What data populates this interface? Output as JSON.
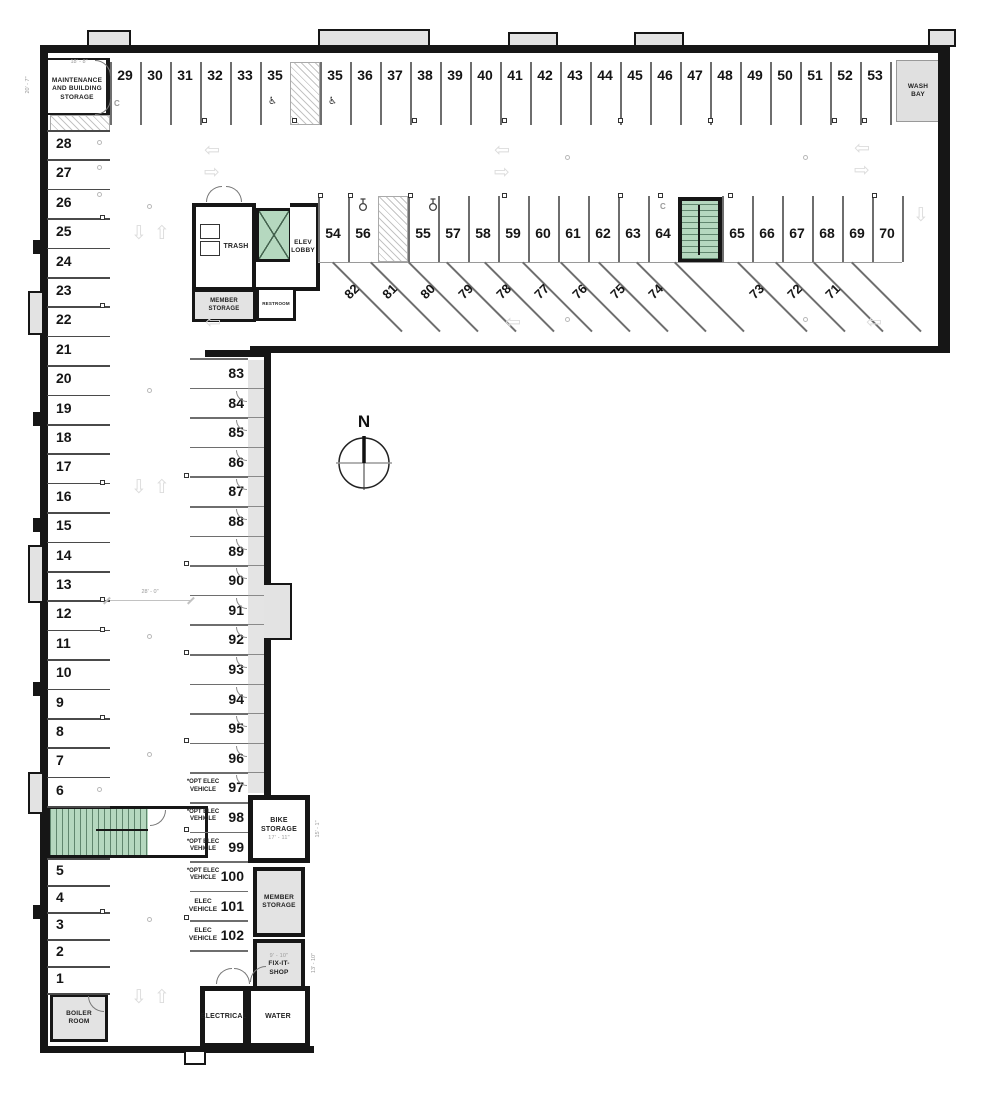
{
  "north_label": "N",
  "rooms": {
    "maintenance": "MAINTENANCE AND BUILDING STORAGE",
    "wash_bay": "WASH BAY",
    "trash": "TRASH",
    "elev_lobby": "ELEV LOBBY",
    "member_storage": "MEMBER STORAGE",
    "restroom": "RESTROOM",
    "bike_storage": "BIKE STORAGE",
    "fixit_shop": "FIX-IT- SHOP",
    "electrical": "ELECTRICAL",
    "water": "WATER",
    "boiler": "BOILER ROOM"
  },
  "dims": {
    "maint_w": "18' - 8\"",
    "maint_h": "20' - 7\"",
    "aisle_w": "28' - 0\"",
    "bike_w": "17' - 11\"",
    "bike_h": "15' - 1\"",
    "fixit_w": "9' - 10\"",
    "fixit_h": "13' - 10\""
  },
  "ev_labels": {
    "opt": "*OPT ELEC VEHICLE",
    "ev": "ELEC VEHICLE"
  },
  "icons": {
    "arrow_left": "⇦",
    "arrow_right": "⇨",
    "arrow_up": "⇧",
    "arrow_down": "⇩",
    "wheelchair": "♿",
    "compact_marker": "C"
  },
  "spaces": {
    "top_row": [
      {
        "n": "29"
      },
      {
        "n": "30"
      },
      {
        "n": "31"
      },
      {
        "n": "32"
      },
      {
        "n": "33"
      },
      {
        "n": "35",
        "hc": true
      },
      {
        "hatch": true
      },
      {
        "n": "35",
        "hc": true
      },
      {
        "n": "36"
      },
      {
        "n": "37"
      },
      {
        "n": "38"
      },
      {
        "n": "39"
      },
      {
        "n": "40"
      },
      {
        "n": "41"
      },
      {
        "n": "42"
      },
      {
        "n": "43"
      },
      {
        "n": "44"
      },
      {
        "n": "45"
      },
      {
        "n": "46"
      },
      {
        "n": "47"
      },
      {
        "n": "48"
      },
      {
        "n": "49"
      },
      {
        "n": "50"
      },
      {
        "n": "51"
      },
      {
        "n": "52"
      },
      {
        "n": "53"
      }
    ],
    "mid_row": [
      {
        "n": "54"
      },
      {
        "n": "56",
        "moto": true
      },
      {
        "hatch": true
      },
      {
        "n": "55",
        "moto": true
      },
      {
        "n": "57"
      },
      {
        "n": "58"
      },
      {
        "n": "59"
      },
      {
        "n": "60"
      },
      {
        "n": "61"
      },
      {
        "n": "62"
      },
      {
        "n": "63"
      },
      {
        "n": "64"
      },
      {
        "stair": true
      },
      {
        "n": "65"
      },
      {
        "n": "66"
      },
      {
        "n": "67"
      },
      {
        "n": "68"
      },
      {
        "n": "69"
      },
      {
        "n": "70"
      }
    ],
    "angled_row": [
      "82",
      "81",
      "80",
      "79",
      "78",
      "77",
      "76",
      "75",
      "74",
      "73",
      "72",
      "71"
    ],
    "left_col_upper": [
      "28",
      "27",
      "26",
      "25",
      "24",
      "23",
      "22",
      "21",
      "20",
      "19",
      "18",
      "17",
      "16",
      "15",
      "14",
      "13",
      "12",
      "11",
      "10",
      "9",
      "8",
      "7",
      "6"
    ],
    "left_col_lower": [
      "5",
      "4",
      "3",
      "2",
      "1"
    ],
    "center_col": [
      {
        "n": "83"
      },
      {
        "n": "84"
      },
      {
        "n": "85"
      },
      {
        "n": "86"
      },
      {
        "n": "87"
      },
      {
        "n": "88"
      },
      {
        "n": "89"
      },
      {
        "n": "90"
      },
      {
        "n": "91"
      },
      {
        "n": "92"
      },
      {
        "n": "93"
      },
      {
        "n": "94"
      },
      {
        "n": "95"
      },
      {
        "n": "96"
      },
      {
        "n": "97",
        "t": "opt"
      },
      {
        "n": "98",
        "t": "opt"
      },
      {
        "n": "99",
        "t": "opt"
      },
      {
        "n": "100",
        "t": "opt"
      },
      {
        "n": "101",
        "t": "ev"
      },
      {
        "n": "102",
        "t": "ev"
      }
    ]
  }
}
